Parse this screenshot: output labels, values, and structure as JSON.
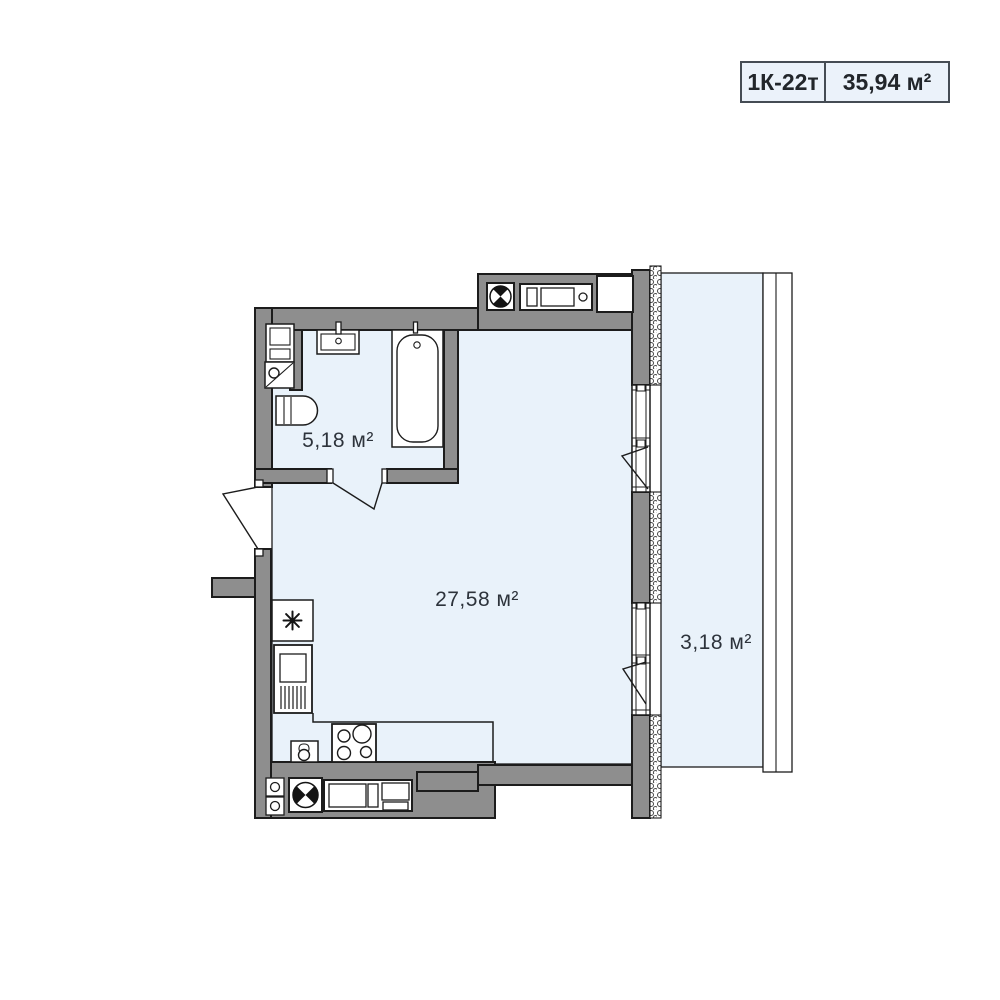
{
  "title_badge": {
    "unit_code": "1К-22т",
    "total_area": "35,94 м²"
  },
  "rooms": [
    {
      "id": "bathroom",
      "area": "5,18 м²"
    },
    {
      "id": "living_kitchen",
      "area": "27,58 м²"
    },
    {
      "id": "balcony",
      "area": "3,18 м²"
    }
  ],
  "colors": {
    "wall": "#8e8e8e",
    "outline": "#1c1c1c",
    "floor": "#e9f2fa",
    "badge_background": "#ebf2fa",
    "badge_border": "#454c54",
    "label_text": "#2d333b"
  },
  "icons": [
    {
      "name": "ventilation-shaft-icon",
      "shape": "circle with two opposite black quadrants"
    },
    {
      "name": "water-heater-icon",
      "shape": "eight-ray asterisk in square"
    }
  ]
}
